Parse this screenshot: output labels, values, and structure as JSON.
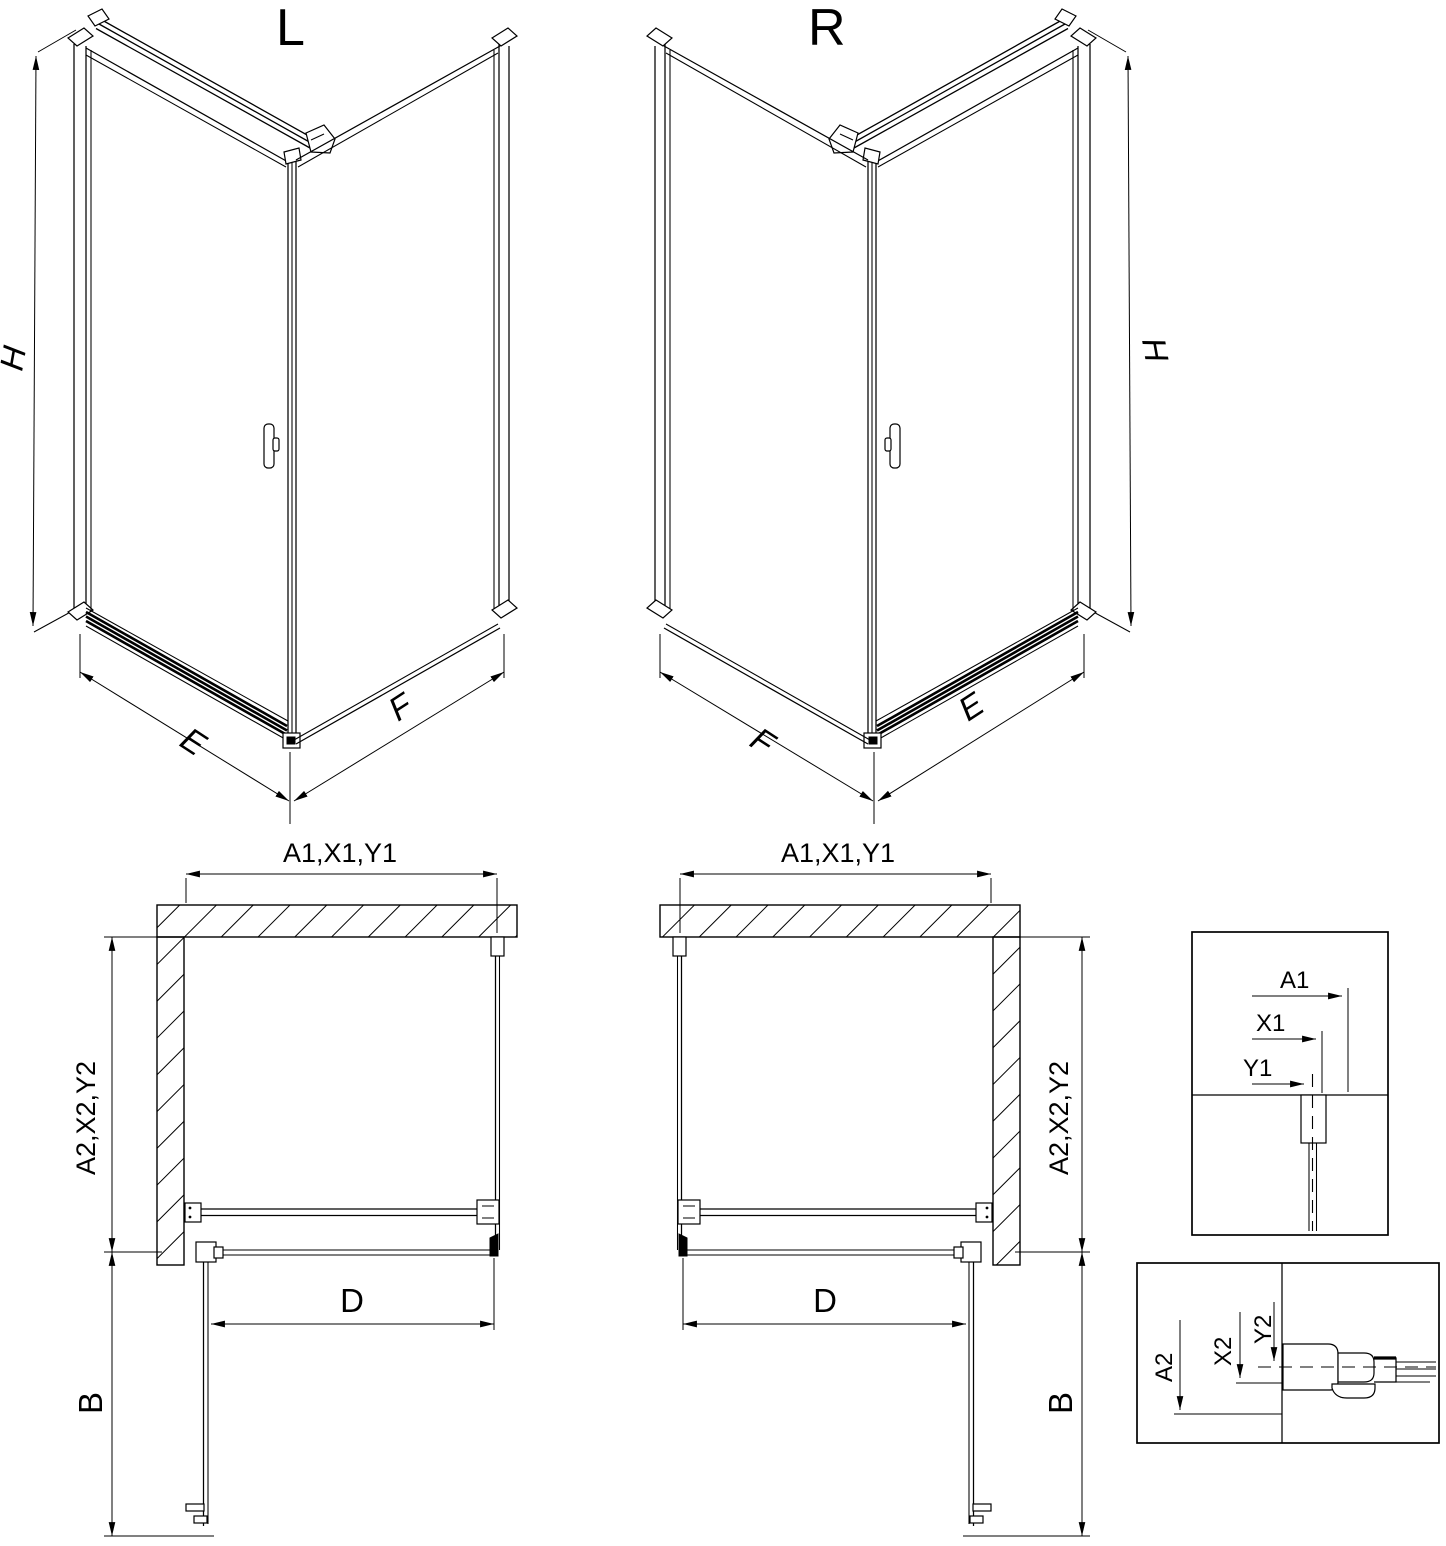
{
  "left_view": {
    "label": "L",
    "h": "H",
    "e": "E",
    "f": "F"
  },
  "right_view": {
    "label": "R",
    "h": "H",
    "e": "E",
    "f": "F"
  },
  "left_plan": {
    "a1": "A1,X1,Y1",
    "a2": "A2,X2,Y2",
    "d": "D",
    "b": "B"
  },
  "right_plan": {
    "a1": "A1,X1,Y1",
    "a2": "A2,X2,Y2",
    "d": "D",
    "b": "B"
  },
  "detail_top": {
    "a1": "A1",
    "x1": "X1",
    "y1": "Y1"
  },
  "detail_bottom": {
    "a2": "A2",
    "x2": "X2",
    "y2": "Y2"
  }
}
